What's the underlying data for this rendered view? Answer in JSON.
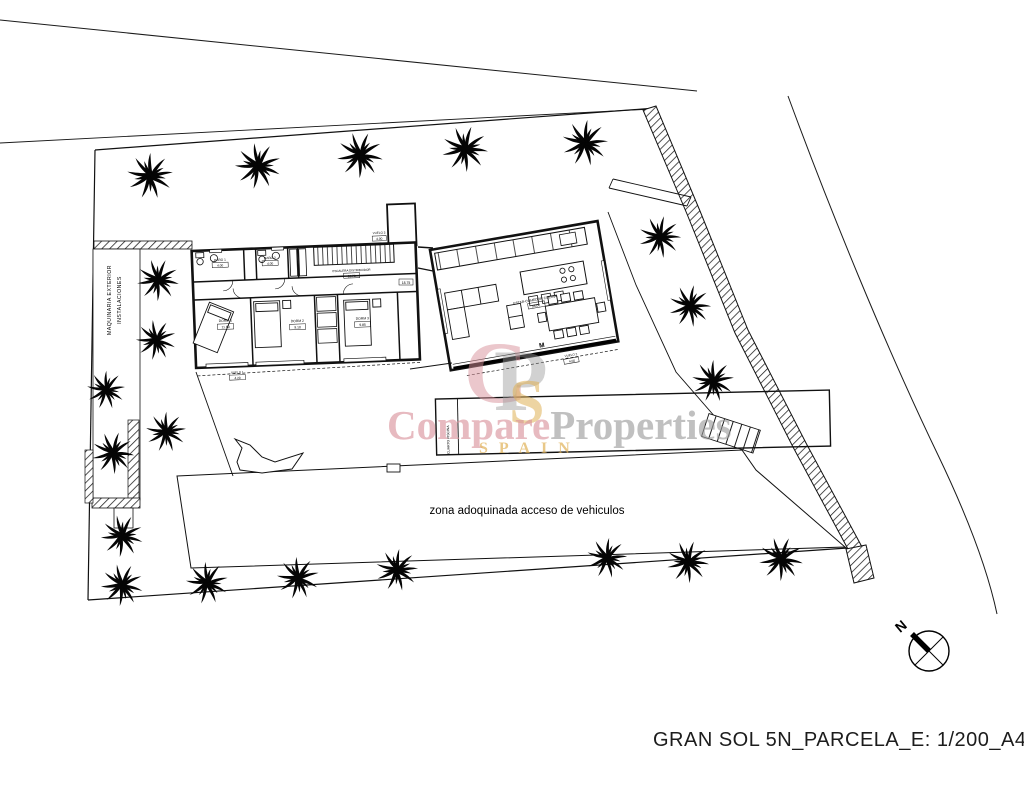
{
  "title_block": {
    "text": "GRAN SOL 5N_PARCELA_E: 1/200_A4"
  },
  "watermark": {
    "monogram": {
      "c": "C",
      "p": "P",
      "s": "S"
    },
    "word_pink": "Compare",
    "word_gray": "Properties",
    "word_gold": "SPAIN",
    "colors": {
      "pink": "#d9919a",
      "gray": "#9a9a9a",
      "gold": "#e0b257"
    }
  },
  "annotations": {
    "zona_label": "zona adoquinada acceso de vehiculos",
    "machinery_line1": "MAQUINARIA EXTERIOR",
    "machinery_line2": "INSTALACIONES",
    "pool_room_label": "CUARTO PISCINA",
    "door_marker": "M",
    "north_label": "N",
    "area_box_right": "18.75"
  },
  "rooms": [
    {
      "name": "BAÑO 1",
      "area": "4.00"
    },
    {
      "name": "BAÑO 2",
      "area": "4.00"
    },
    {
      "name": "ESCALERA DISTRIBUIDOR",
      "area": "16.70"
    },
    {
      "name": "DORM 1",
      "area": "11.60"
    },
    {
      "name": "DORM 2",
      "area": "9.10"
    },
    {
      "name": "DORM 3",
      "area": "9.85"
    },
    {
      "name": "ESTAR-COMEDOR COCINA",
      "area": "55.00"
    },
    {
      "name": "VUELO 1",
      "area": "4.20"
    },
    {
      "name": "VUELO 2",
      "area": "4.00"
    },
    {
      "name": "VUELO 3",
      "area": "4.00"
    }
  ]
}
